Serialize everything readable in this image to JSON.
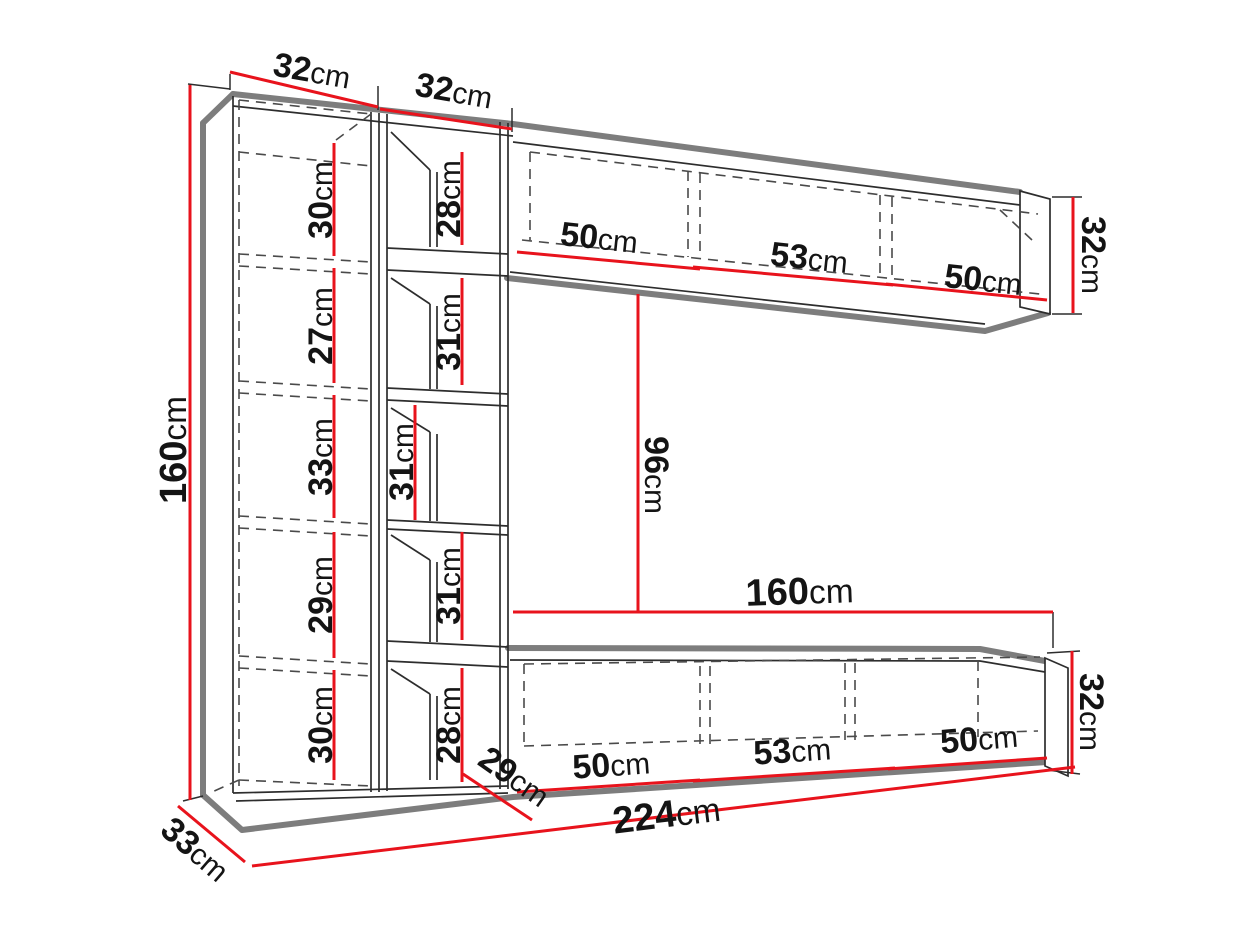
{
  "dims": {
    "col_left_width": {
      "value": "32",
      "unit": "cm"
    },
    "col_inner_width": {
      "value": "32",
      "unit": "cm"
    },
    "total_height": {
      "value": "160",
      "unit": "cm"
    },
    "col_left_sections": [
      {
        "value": "30",
        "unit": "cm"
      },
      {
        "value": "27",
        "unit": "cm"
      },
      {
        "value": "33",
        "unit": "cm"
      },
      {
        "value": "29",
        "unit": "cm"
      },
      {
        "value": "30",
        "unit": "cm"
      }
    ],
    "col_inner_sections": [
      {
        "value": "28",
        "unit": "cm"
      },
      {
        "value": "31",
        "unit": "cm"
      },
      {
        "value": "31",
        "unit": "cm"
      },
      {
        "value": "31",
        "unit": "cm"
      },
      {
        "value": "28",
        "unit": "cm"
      }
    ],
    "top_cabinet_widths": [
      {
        "value": "50",
        "unit": "cm"
      },
      {
        "value": "53",
        "unit": "cm"
      },
      {
        "value": "50",
        "unit": "cm"
      }
    ],
    "top_cabinet_height": {
      "value": "32",
      "unit": "cm"
    },
    "niche_height": {
      "value": "96",
      "unit": "cm"
    },
    "tv_stand_length": {
      "value": "160",
      "unit": "cm"
    },
    "tv_stand_widths": [
      {
        "value": "50",
        "unit": "cm"
      },
      {
        "value": "53",
        "unit": "cm"
      },
      {
        "value": "50",
        "unit": "cm"
      }
    ],
    "tv_stand_height": {
      "value": "32",
      "unit": "cm"
    },
    "tv_stand_depth": {
      "value": "29",
      "unit": "cm"
    },
    "cabinet_depth": {
      "value": "33",
      "unit": "cm"
    },
    "total_width": {
      "value": "224",
      "unit": "cm"
    }
  }
}
